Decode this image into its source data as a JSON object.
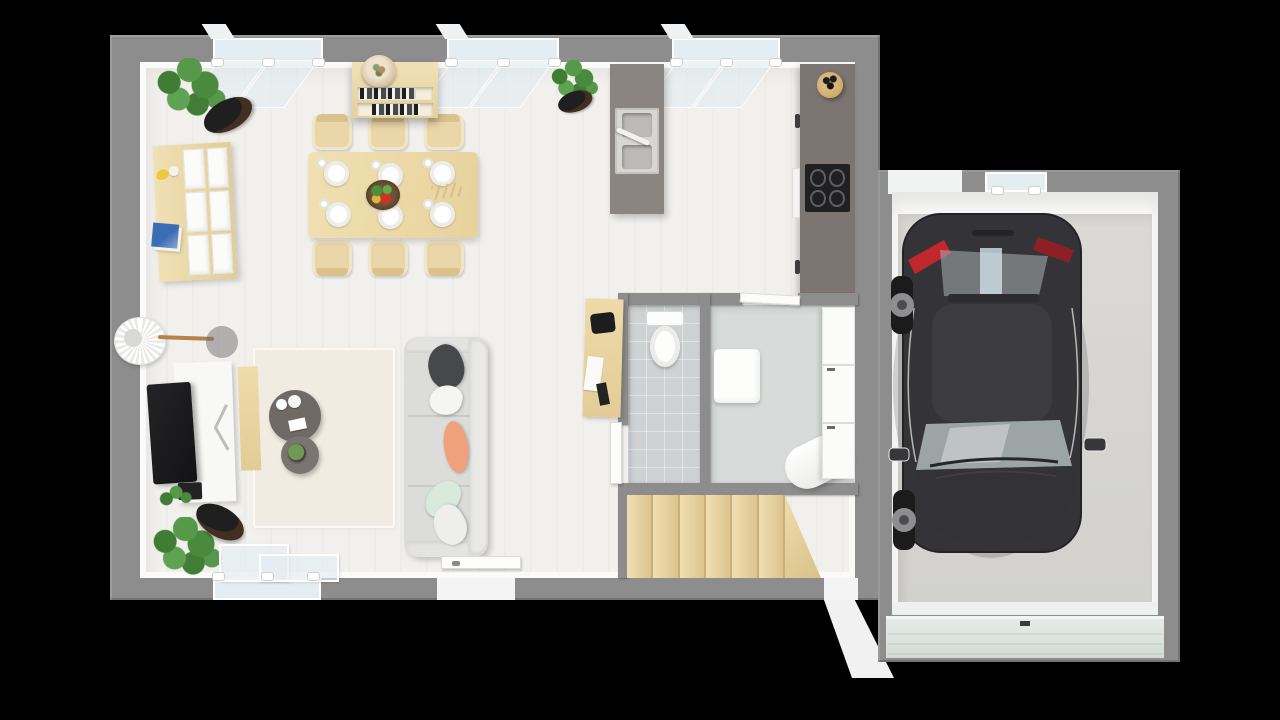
{
  "scene": {
    "description": "3D top-down architectural floor plan render of a single-storey house with open living, dining and kitchen space, WC, bathroom-utility room, staircase, entrance, and attached garage containing one parked dark car",
    "background_color": "#000000",
    "rooms": [
      "living-room",
      "dining-area",
      "kitchen",
      "wc",
      "bathroom-utility",
      "staircase",
      "entrance",
      "garage"
    ],
    "colors": {
      "wall": "#8d8d8d",
      "interior_face": "#fafaf8",
      "floor": "#f2f0ed",
      "rug": "#f2ebe1",
      "tile": "#ced2d3",
      "bath_floor": "#d8dbd9",
      "wood": "#ead7a9",
      "wood_dark": "#d9c28c",
      "counter": "#7c7571",
      "island": "#8b8582",
      "sink_unit": "#d8d6d3",
      "sink_basin": "#bcbab7",
      "cooktop": "#202023",
      "sofa": "#dcdcda",
      "sofa_back": "#e9e9e7",
      "coffee_table_big": "#6f6a66",
      "coffee_table_small": "#7a7571",
      "plant_pot": "#1f1f1f",
      "glass": "#e4edf2",
      "car_body": "#343438",
      "car_roof": "#3c3c40",
      "car_glass": "#a9b0b2",
      "car_red": "#c1272d",
      "wheel_tire": "#1b1b1c",
      "wheel_alloy": "#8e8e90",
      "garage_floor": "#d6d5d1",
      "garage_door": "#dee4e1",
      "threshold": "#eef1f1",
      "stair_wood_light": "#f0dfb2",
      "stair_wood_dark": "#dcc48e"
    },
    "dining": {
      "seats": 6,
      "place_settings": 6
    },
    "kitchen": {
      "cooktop_burners": 4,
      "sink_basins": 2
    },
    "stairs": {
      "steps": 6
    },
    "living": {
      "sofa_pillow_colors": [
        "#46484b",
        "#f5f5f3",
        "#f1a07c",
        "#d9e9dd",
        "#eeeeec"
      ]
    },
    "windows": {
      "top_wall_count": 3,
      "bottom_wall_count": 1,
      "garage_count": 1
    },
    "garage": {
      "cars": 1
    }
  }
}
